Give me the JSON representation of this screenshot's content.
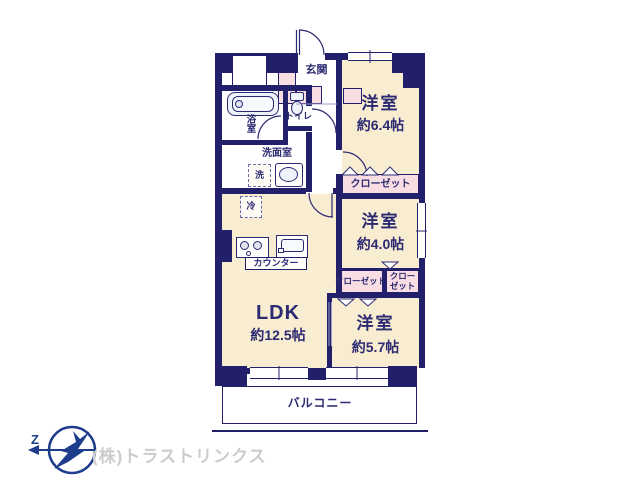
{
  "colors": {
    "wall": "#23206b",
    "room_fill": "#f8ecd1",
    "closet_fill": "#f8dde3",
    "fixture_fill": "#eef3fb",
    "text": "#2b2a72",
    "light_line": "#9aa0c8",
    "logo": "#1d3c8c",
    "company_text": "#cccccc"
  },
  "plan": {
    "entrance_label": "玄関",
    "toilet_label": "トイレ",
    "bath_label": "浴室",
    "washroom_label": "洗面室",
    "washer_label": "洗",
    "fridge_label": "冷",
    "counter_label": "カウンター",
    "balcony_label": "バルコニー",
    "rooms": [
      {
        "name": "洋室",
        "size": "約6.4帖"
      },
      {
        "name": "洋室",
        "size": "約4.0帖"
      },
      {
        "name": "洋室",
        "size": "約5.7帖"
      },
      {
        "name": "LDK",
        "size": "約12.5帖"
      }
    ],
    "closets": {
      "closet_top": "クローゼット",
      "closet_mid": "クローゼット",
      "closet_small_line1": "クロー",
      "closet_small_line2": "ゼット"
    }
  },
  "footer": {
    "company_name": "(株)トラストリンクス",
    "compass_letter": "Z"
  }
}
